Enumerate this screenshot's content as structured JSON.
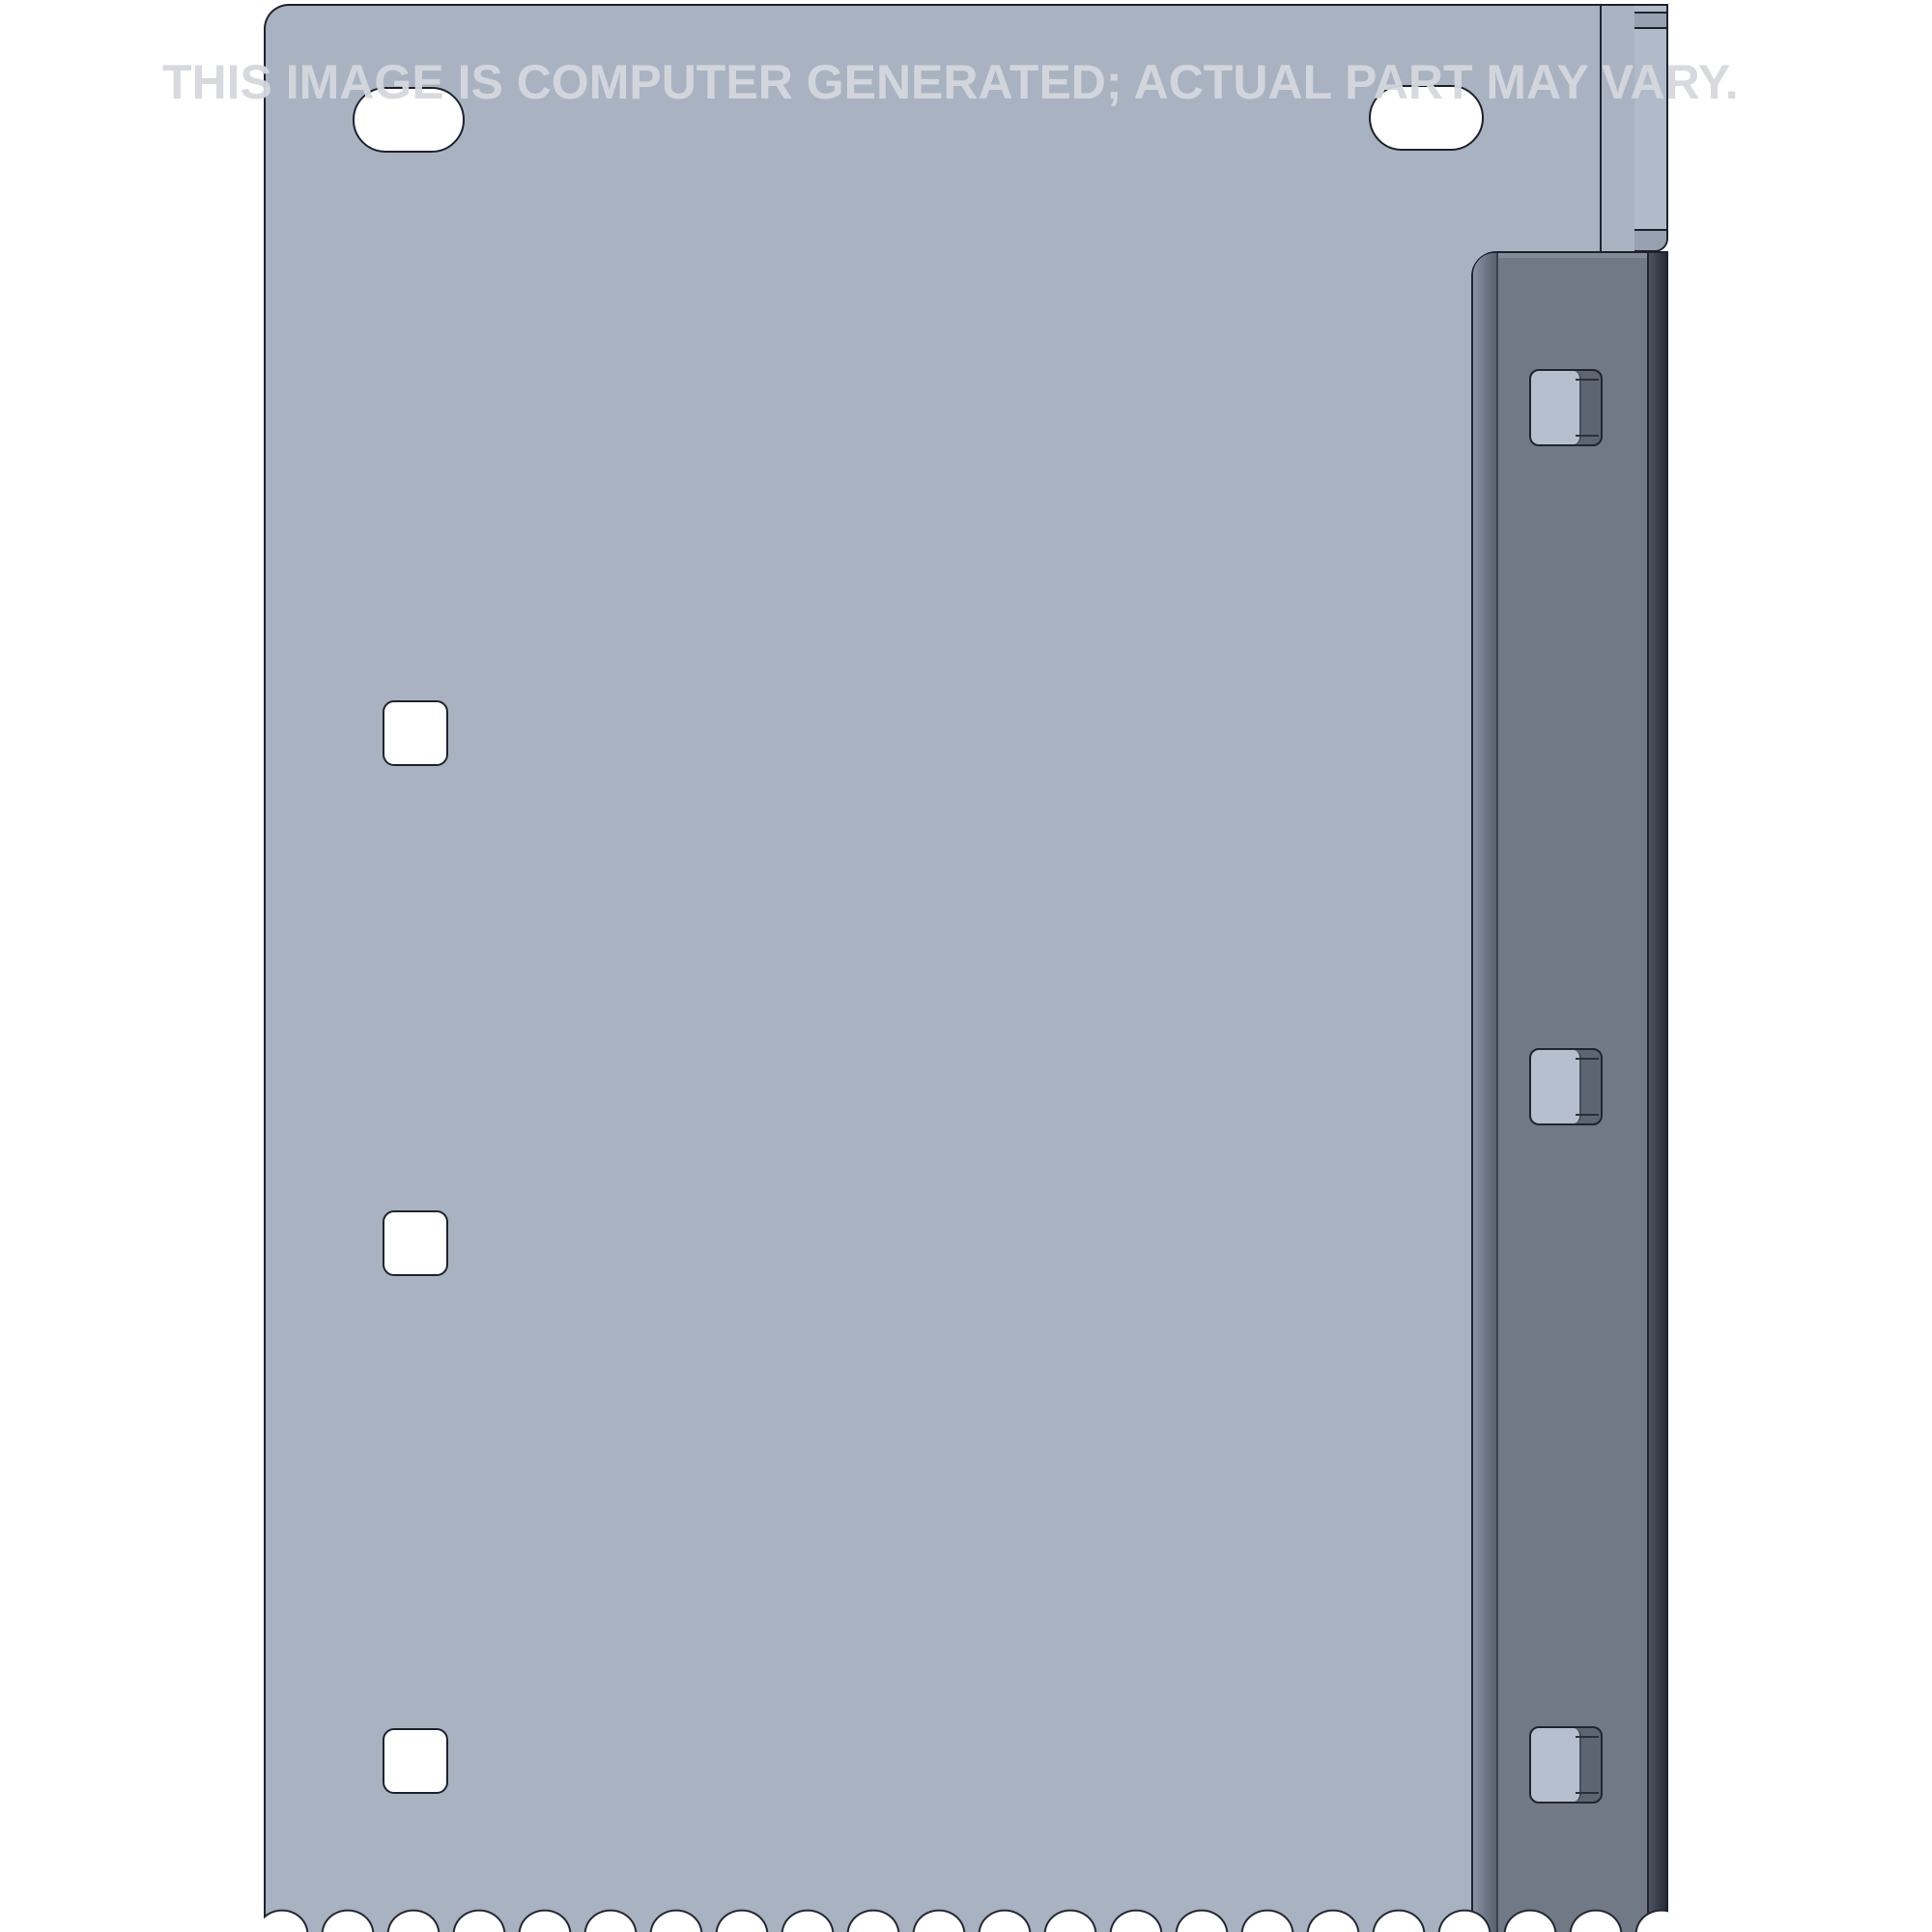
{
  "watermark": {
    "text": "THIS IMAGE IS COMPUTER GENERATED; ACTUAL PART MAY VARY."
  },
  "part_render": {
    "description": "shaded-cad-render-of-sheet-metal-plate",
    "features": {
      "slot_holes": [
        "slot-hole-top-left",
        "slot-hole-top-right"
      ],
      "square_holes": [
        "square-hole-top",
        "square-hole-middle",
        "square-hole-bottom"
      ],
      "rail_clips": [
        "rail-clip-top",
        "rail-clip-middle",
        "rail-clip-bottom"
      ],
      "bottom_edge": "serrated-scalloped-edge"
    }
  },
  "colors": {
    "bg": "#ffffff",
    "line": "#1d232d",
    "plate": "#a9b2c1",
    "strip": "#b1bac8",
    "band": "#96a0b0",
    "rail": "#717987",
    "rail-bevel-light": "#8a93a1",
    "rail-bevel-dark": "#596070",
    "rail-edge-light": "#4d5462",
    "rail-edge-dark": "#262b34",
    "rail-top-face": "#838b99",
    "clip-face": "#b6bfce",
    "clip-side": "#5d6472",
    "clip-line": "#2b303a",
    "watermark": "#d5d8de"
  }
}
